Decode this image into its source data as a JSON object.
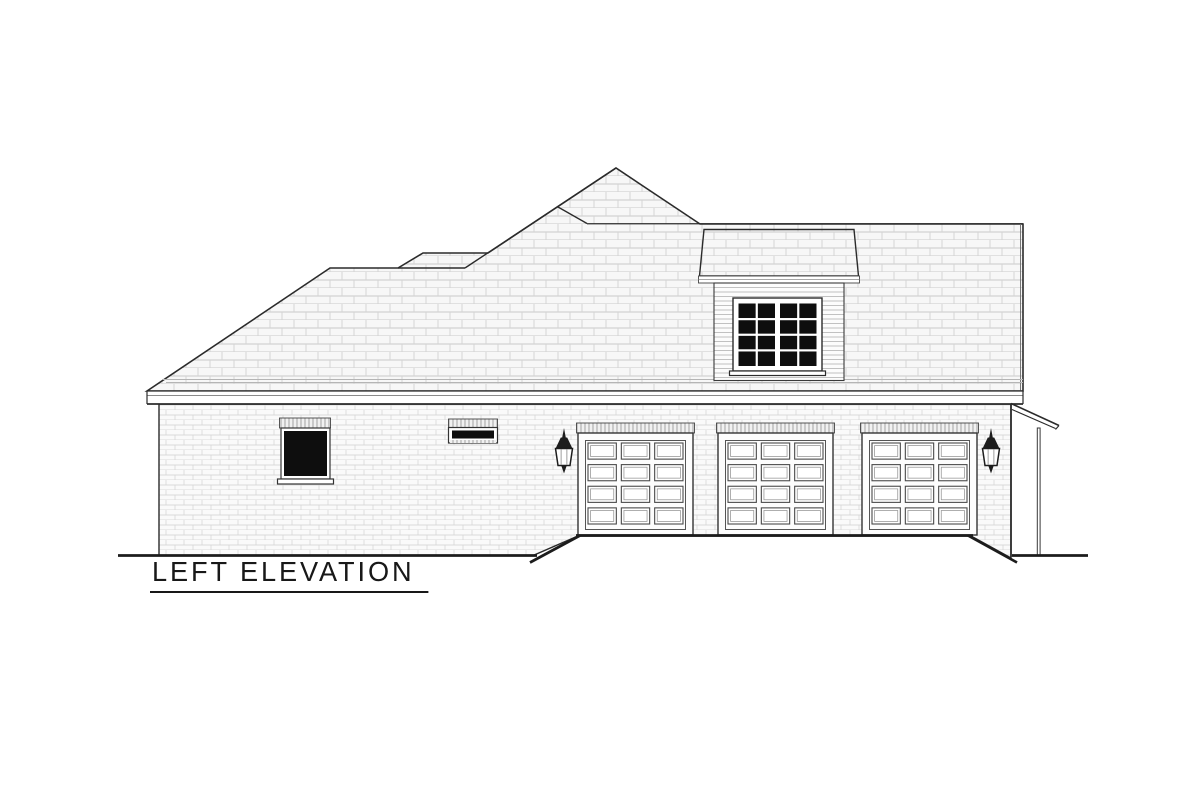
{
  "title": {
    "label": "LEFT ELEVATION"
  },
  "drawing": {
    "type": "house-left-elevation-plan",
    "ink_color": "#2b2b2b",
    "heavy_line_color": "#1c1c1c",
    "texture_line_color": "#c6c6c6",
    "glass_color": "#0e0e0e",
    "background": "#ffffff"
  },
  "garage": {
    "door_count": 3,
    "door_width": 115,
    "header_top": 423,
    "header_height": 10,
    "door_top": 433,
    "door_bottom": 535,
    "doors": [
      {
        "x": 578
      },
      {
        "x": 718
      },
      {
        "x": 862
      }
    ],
    "panel_grid": {
      "rows": 4,
      "cols": 3
    }
  },
  "dormer": {
    "window": {
      "sashes": 2,
      "cols_per_sash": 2,
      "rows": 4
    }
  },
  "lanterns": {
    "count": 2,
    "positions": [
      {
        "cx": 564
      },
      {
        "cx": 991
      }
    ]
  }
}
